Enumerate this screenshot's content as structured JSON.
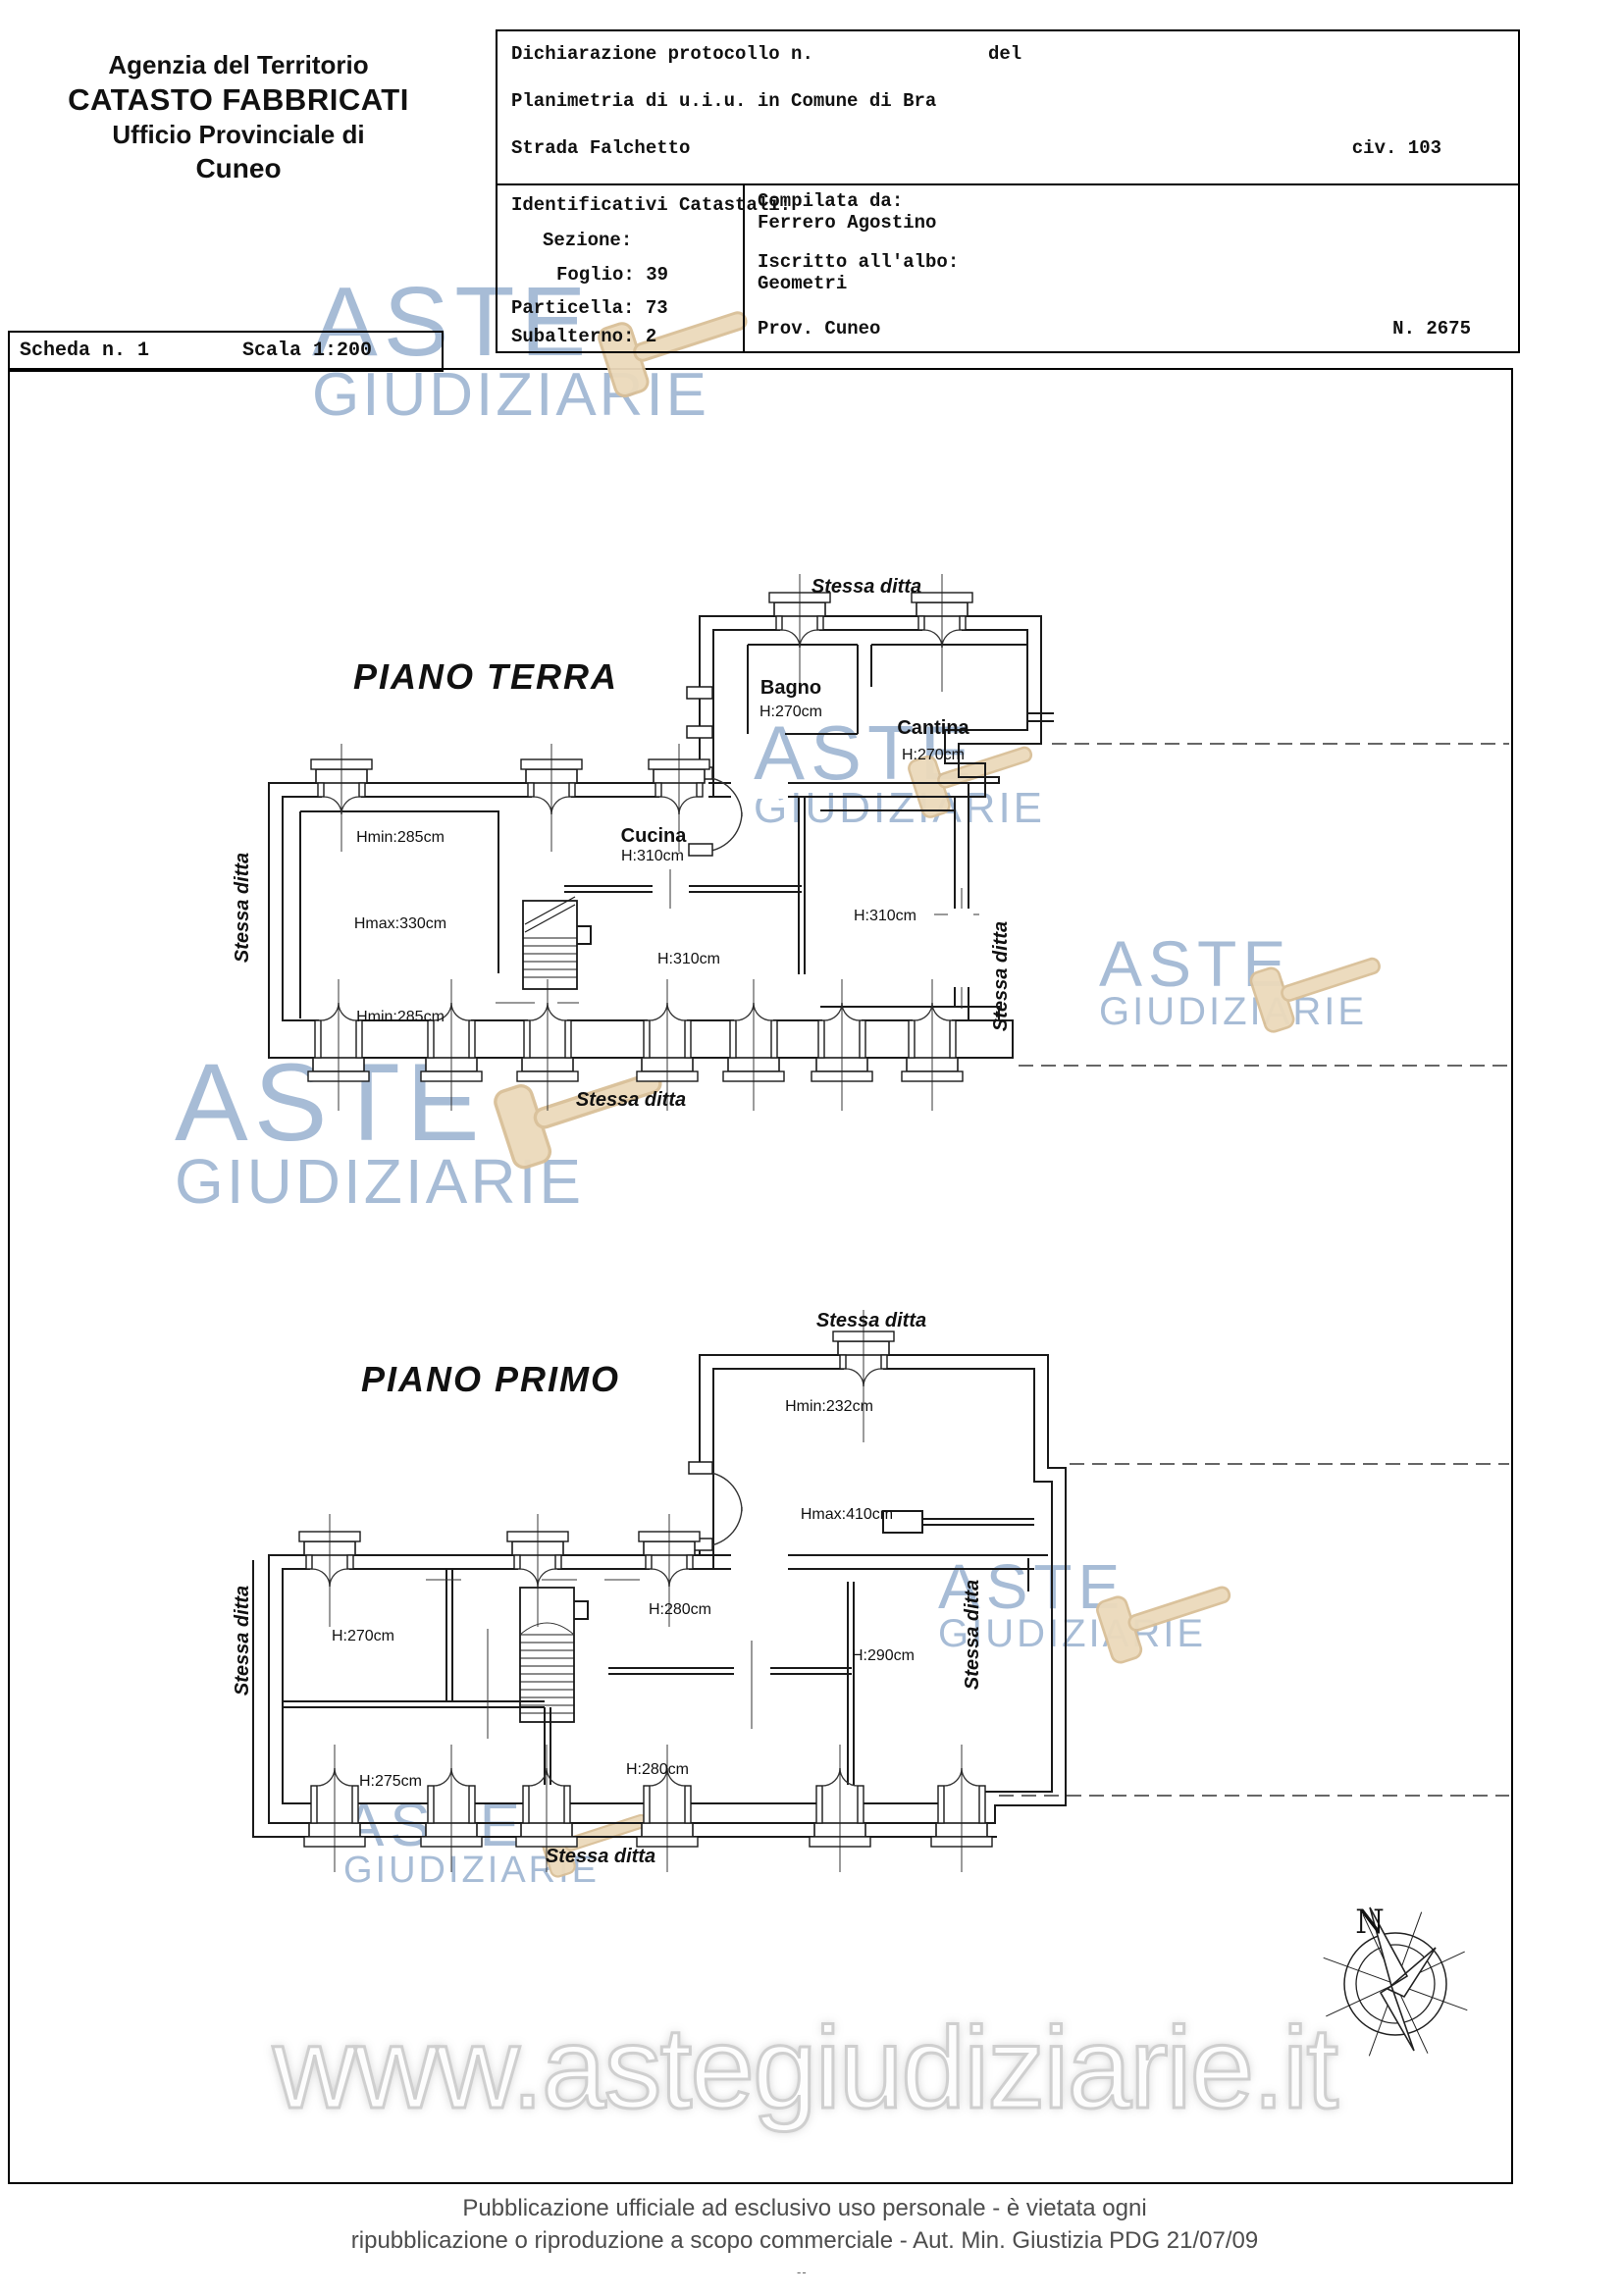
{
  "agency": {
    "line1": "Agenzia del Territorio",
    "line2": "CATASTO FABBRICATI",
    "line3": "Ufficio Provinciale di",
    "line4": "Cuneo"
  },
  "declaration": {
    "protocol_label": "Dichiarazione protocollo n.",
    "del_label": "del",
    "planimetria": "Planimetria di u.i.u. in Comune di Bra",
    "street": "Strada Falchetto",
    "civic": "civ. 103"
  },
  "cadastral": {
    "title": "Identificativi Catastali:",
    "sezione": "Sezione:",
    "foglio": "Foglio: 39",
    "particella": "Particella: 73",
    "subalterno": "Subalterno: 2"
  },
  "compiler": {
    "label": "Compilata da:",
    "name": "Ferrero Agostino",
    "albo_label": "Iscritto all'albo:",
    "albo": "Geometri",
    "prov": "Prov. Cuneo",
    "num": "N. 2675"
  },
  "sheet": {
    "scheda": "Scheda n. 1",
    "scala": "Scala 1:200"
  },
  "floors": {
    "terra": {
      "title": "PIANO TERRA",
      "stessa": "Stessa ditta",
      "bagno": "Bagno",
      "bagno_h": "H:270cm",
      "cantina": "Cantina",
      "cantina_h": "H:270cm",
      "hmin_top": "Hmin:285cm",
      "hmax": "Hmax:330cm",
      "hmin_bottom": "Hmin:285cm",
      "cucina": "Cucina",
      "cucina_h": "H:310cm",
      "sala_h": "H:310cm",
      "dx_h": "H:310cm"
    },
    "primo": {
      "title": "PIANO PRIMO",
      "stessa": "Stessa ditta",
      "hmin": "Hmin:232cm",
      "hmax": "Hmax:410cm",
      "h270": "H:270cm",
      "h275": "H:275cm",
      "h280a": "H:280cm",
      "h280b": "H:280cm",
      "h290": "H:290cm"
    }
  },
  "watermark": {
    "aste": "ASTE",
    "giudiziarie": "GIUDIZIARIE",
    "url": "www.astegiudiziarie.it",
    "blue": "#a7bcd6",
    "gavel_fill": "#ecdabb",
    "gavel_stroke": "#d9bf97"
  },
  "compass": {
    "north": "N"
  },
  "footer": {
    "line1": "Pubblicazione ufficiale ad esclusivo uso personale - è vietata ogni",
    "line2": "ripubblicazione o riproduzione a scopo commerciale - Aut. Min. Giustizia PDG 21/07/09",
    "mark": "--"
  }
}
